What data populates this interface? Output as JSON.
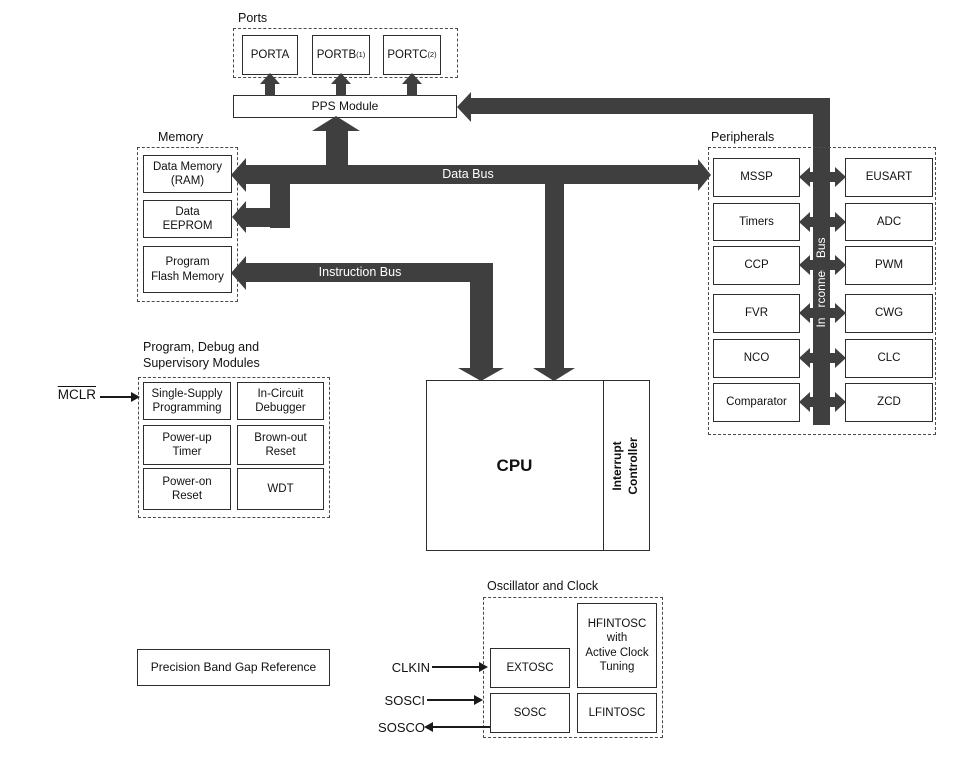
{
  "colors": {
    "bus": "#3f3f3f",
    "box_border": "#2d2d2d",
    "background": "#ffffff"
  },
  "buses": {
    "data_bus_label": "Data Bus",
    "instruction_bus_label": "Instruction Bus",
    "interconnect_bus_label": "Interconnect Bus"
  },
  "ports": {
    "label": "Ports",
    "pps_label": "PPS Module",
    "items": [
      {
        "label": "PORTA",
        "note": ""
      },
      {
        "label": "PORTB",
        "note": "(1)"
      },
      {
        "label": "PORTC",
        "note": "(2)"
      }
    ]
  },
  "memory": {
    "label": "Memory",
    "items": [
      "Data Memory\n(RAM)",
      "Data\nEEPROM",
      "Program\nFlash Memory"
    ]
  },
  "cpu": {
    "label": "CPU",
    "interrupt_label": "Interrupt\nController"
  },
  "peripherals": {
    "label": "Peripherals",
    "left": [
      "MSSP",
      "Timers",
      "CCP",
      "FVR",
      "NCO",
      "Comparator"
    ],
    "right": [
      "EUSART",
      "ADC",
      "PWM",
      "CWG",
      "CLC",
      "ZCD"
    ]
  },
  "debug": {
    "label": "Program, Debug and\nSupervisory Modules",
    "items": [
      "Single-Supply\nProgramming",
      "In-Circuit\nDebugger",
      "Power-up\nTimer",
      "Brown-out\nReset",
      "Power-on\nReset",
      "WDT"
    ],
    "mclr": "MCLR"
  },
  "oscillator": {
    "label": "Oscillator and Clock",
    "extosc": "EXTOSC",
    "hfintosc": "HFINTOSC\nwith\nActive Clock\nTuning",
    "sosc": "SOSC",
    "lfintosc": "LFINTOSC",
    "pins": {
      "clkin": "CLKIN",
      "sosci": "SOSCI",
      "sosco": "SOSCO"
    }
  },
  "bandgap": {
    "label": "Precision Band Gap Reference"
  }
}
